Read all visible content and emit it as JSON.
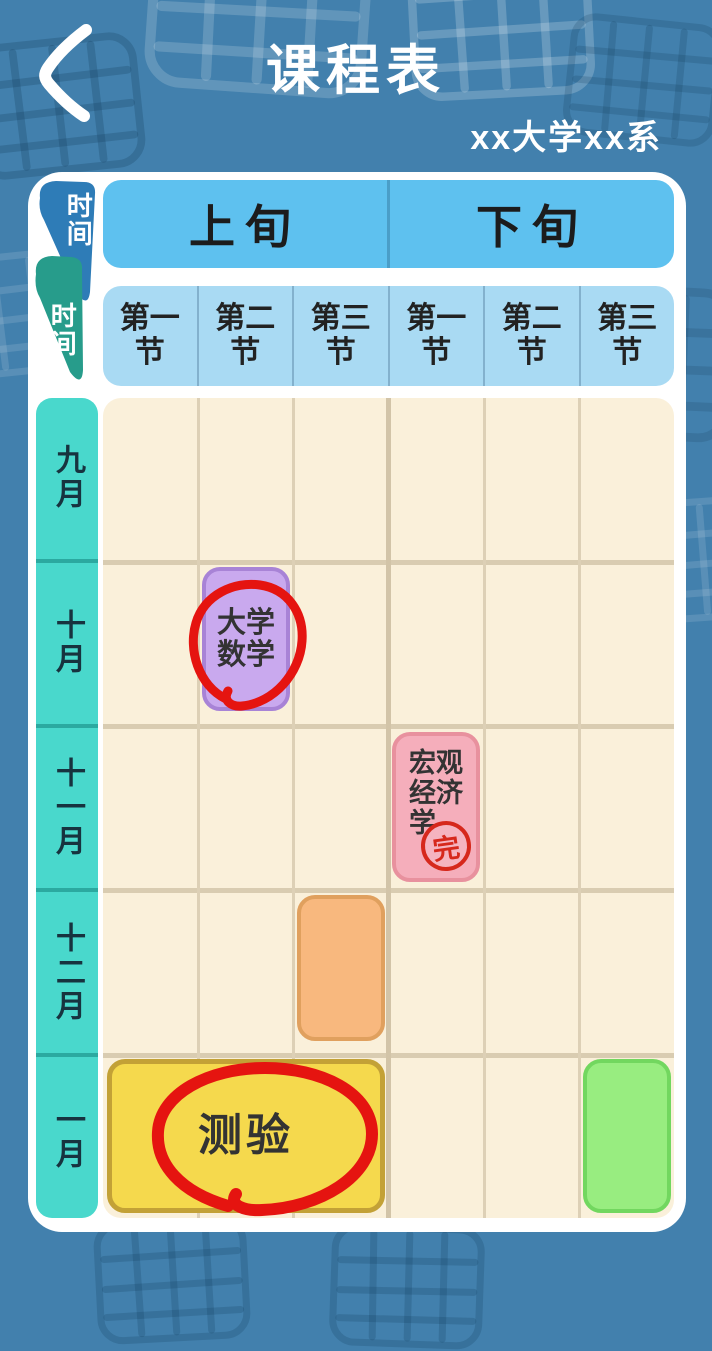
{
  "header": {
    "title": "课程表",
    "subtitle": "xx大学xx系",
    "back_icon": "chevron-left"
  },
  "table": {
    "corner": {
      "top_label": "时间",
      "bottom_label": "时间"
    },
    "periods": [
      {
        "label": "上旬"
      },
      {
        "label": "下旬"
      }
    ],
    "sections": [
      {
        "label": "第一节"
      },
      {
        "label": "第二节"
      },
      {
        "label": "第三节"
      },
      {
        "label": "第一节"
      },
      {
        "label": "第二节"
      },
      {
        "label": "第三节"
      }
    ],
    "months": [
      {
        "label": "九月"
      },
      {
        "label": "十月"
      },
      {
        "label": "十一月"
      },
      {
        "label": "十二月"
      },
      {
        "label": "一月"
      }
    ],
    "courses": [
      {
        "title": "大学数学",
        "month": "十月",
        "period": "上旬",
        "section": "第二节",
        "color": "#c9a9ee",
        "marker": "red-circle"
      },
      {
        "title": "宏观经济学",
        "month": "十一月",
        "period": "下旬",
        "section": "第一节",
        "color": "#f5aebb",
        "stamp": "完"
      },
      {
        "title": "",
        "month": "十二月",
        "period": "上旬",
        "section": "第三节",
        "color": "#f8b87e"
      },
      {
        "title": "测验",
        "month": "一月",
        "period": "上旬",
        "section": "第一节-第三节",
        "color": "#f5d94d",
        "marker": "red-circle"
      },
      {
        "title": "",
        "month": "一月",
        "period": "下旬",
        "section": "第三节",
        "color": "#98ed80"
      }
    ],
    "colors": {
      "background": "#4280ad",
      "panel": "#ffffff",
      "period_header": "#5ec1ef",
      "section_header": "#a9daf3",
      "month_column": "#49d8cc",
      "grid": "#faf0da",
      "grid_line": "#d9ccb1",
      "marker_red": "#e51410",
      "wedge_blue": "#2e7cb7",
      "wedge_teal": "#279c8b"
    }
  }
}
